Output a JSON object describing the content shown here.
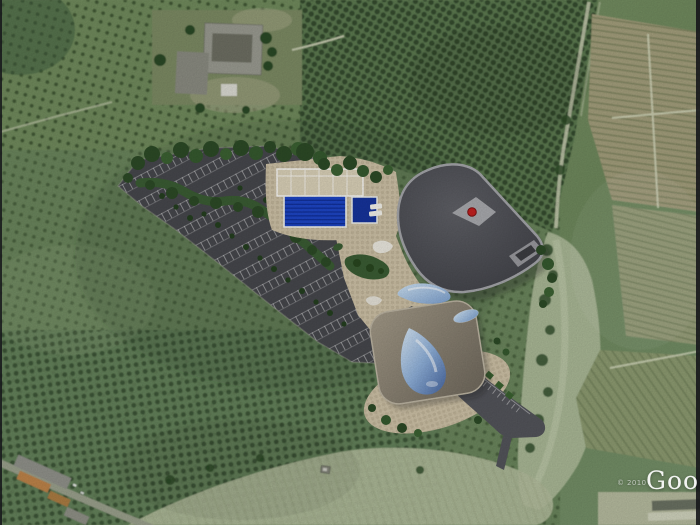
{
  "canvas": {
    "width": 700,
    "height": 525
  },
  "watermark": {
    "copyright": "© 2010",
    "logo_text": "Google"
  },
  "colors": {
    "asphalt": "#46474c",
    "road_asphalt": "#53545a",
    "paving_tan": "#cdc1a6",
    "pool_water": "#1d45c4",
    "small_pool_water": "#16339b",
    "pool_roof": "#d9d0b7",
    "red_skylight": "#c22020",
    "render_tree": "#2c4a26",
    "median_green": "#3a5c33",
    "field_green": "#6a855c",
    "scrub_green": "#5c7950",
    "vineyard_tan": "#a39e7c",
    "riverbed": "#a9b795",
    "farm_roof": "#999a90",
    "orange_roof": "#bd8348"
  },
  "scene": {
    "type": "satellite-aerial-view-with-architectural-site-plan-overlay",
    "overlay": {
      "name": "sports-aquatic-complex-site-plan",
      "parking_rows": 9,
      "olympic_pool_lane_lines": 7,
      "buildings": [
        "pool-hall",
        "dark-roof-pavilion",
        "round-pavilion"
      ]
    },
    "surroundings": [
      "orchards",
      "vineyards",
      "farm-buildings",
      "dry-riverbed",
      "village-road"
    ]
  }
}
